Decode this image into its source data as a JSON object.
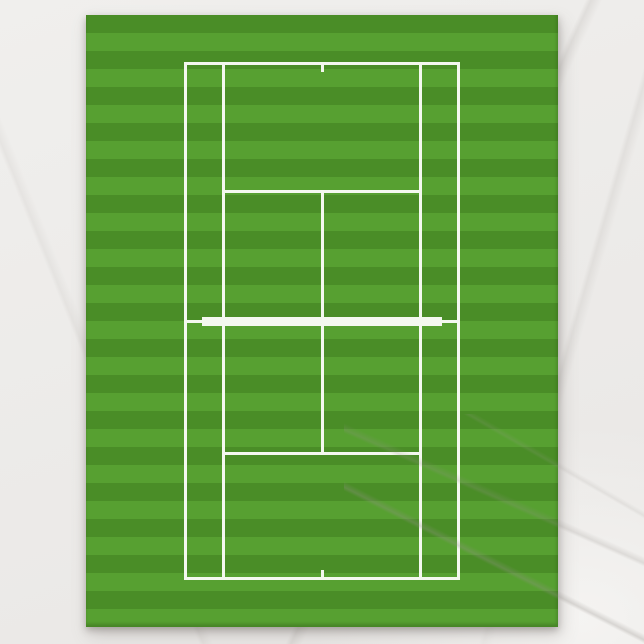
{
  "colors": {
    "background_marble": "#ecebe9",
    "marble_vein": "#9a958f",
    "stripe_dark": "#4a8d27",
    "stripe_light": "#57a031",
    "court_line": "#f4f8ef",
    "paper_shadow": "rgba(110,105,100,0.45)"
  },
  "lawn": {
    "stripe_count": 34
  }
}
